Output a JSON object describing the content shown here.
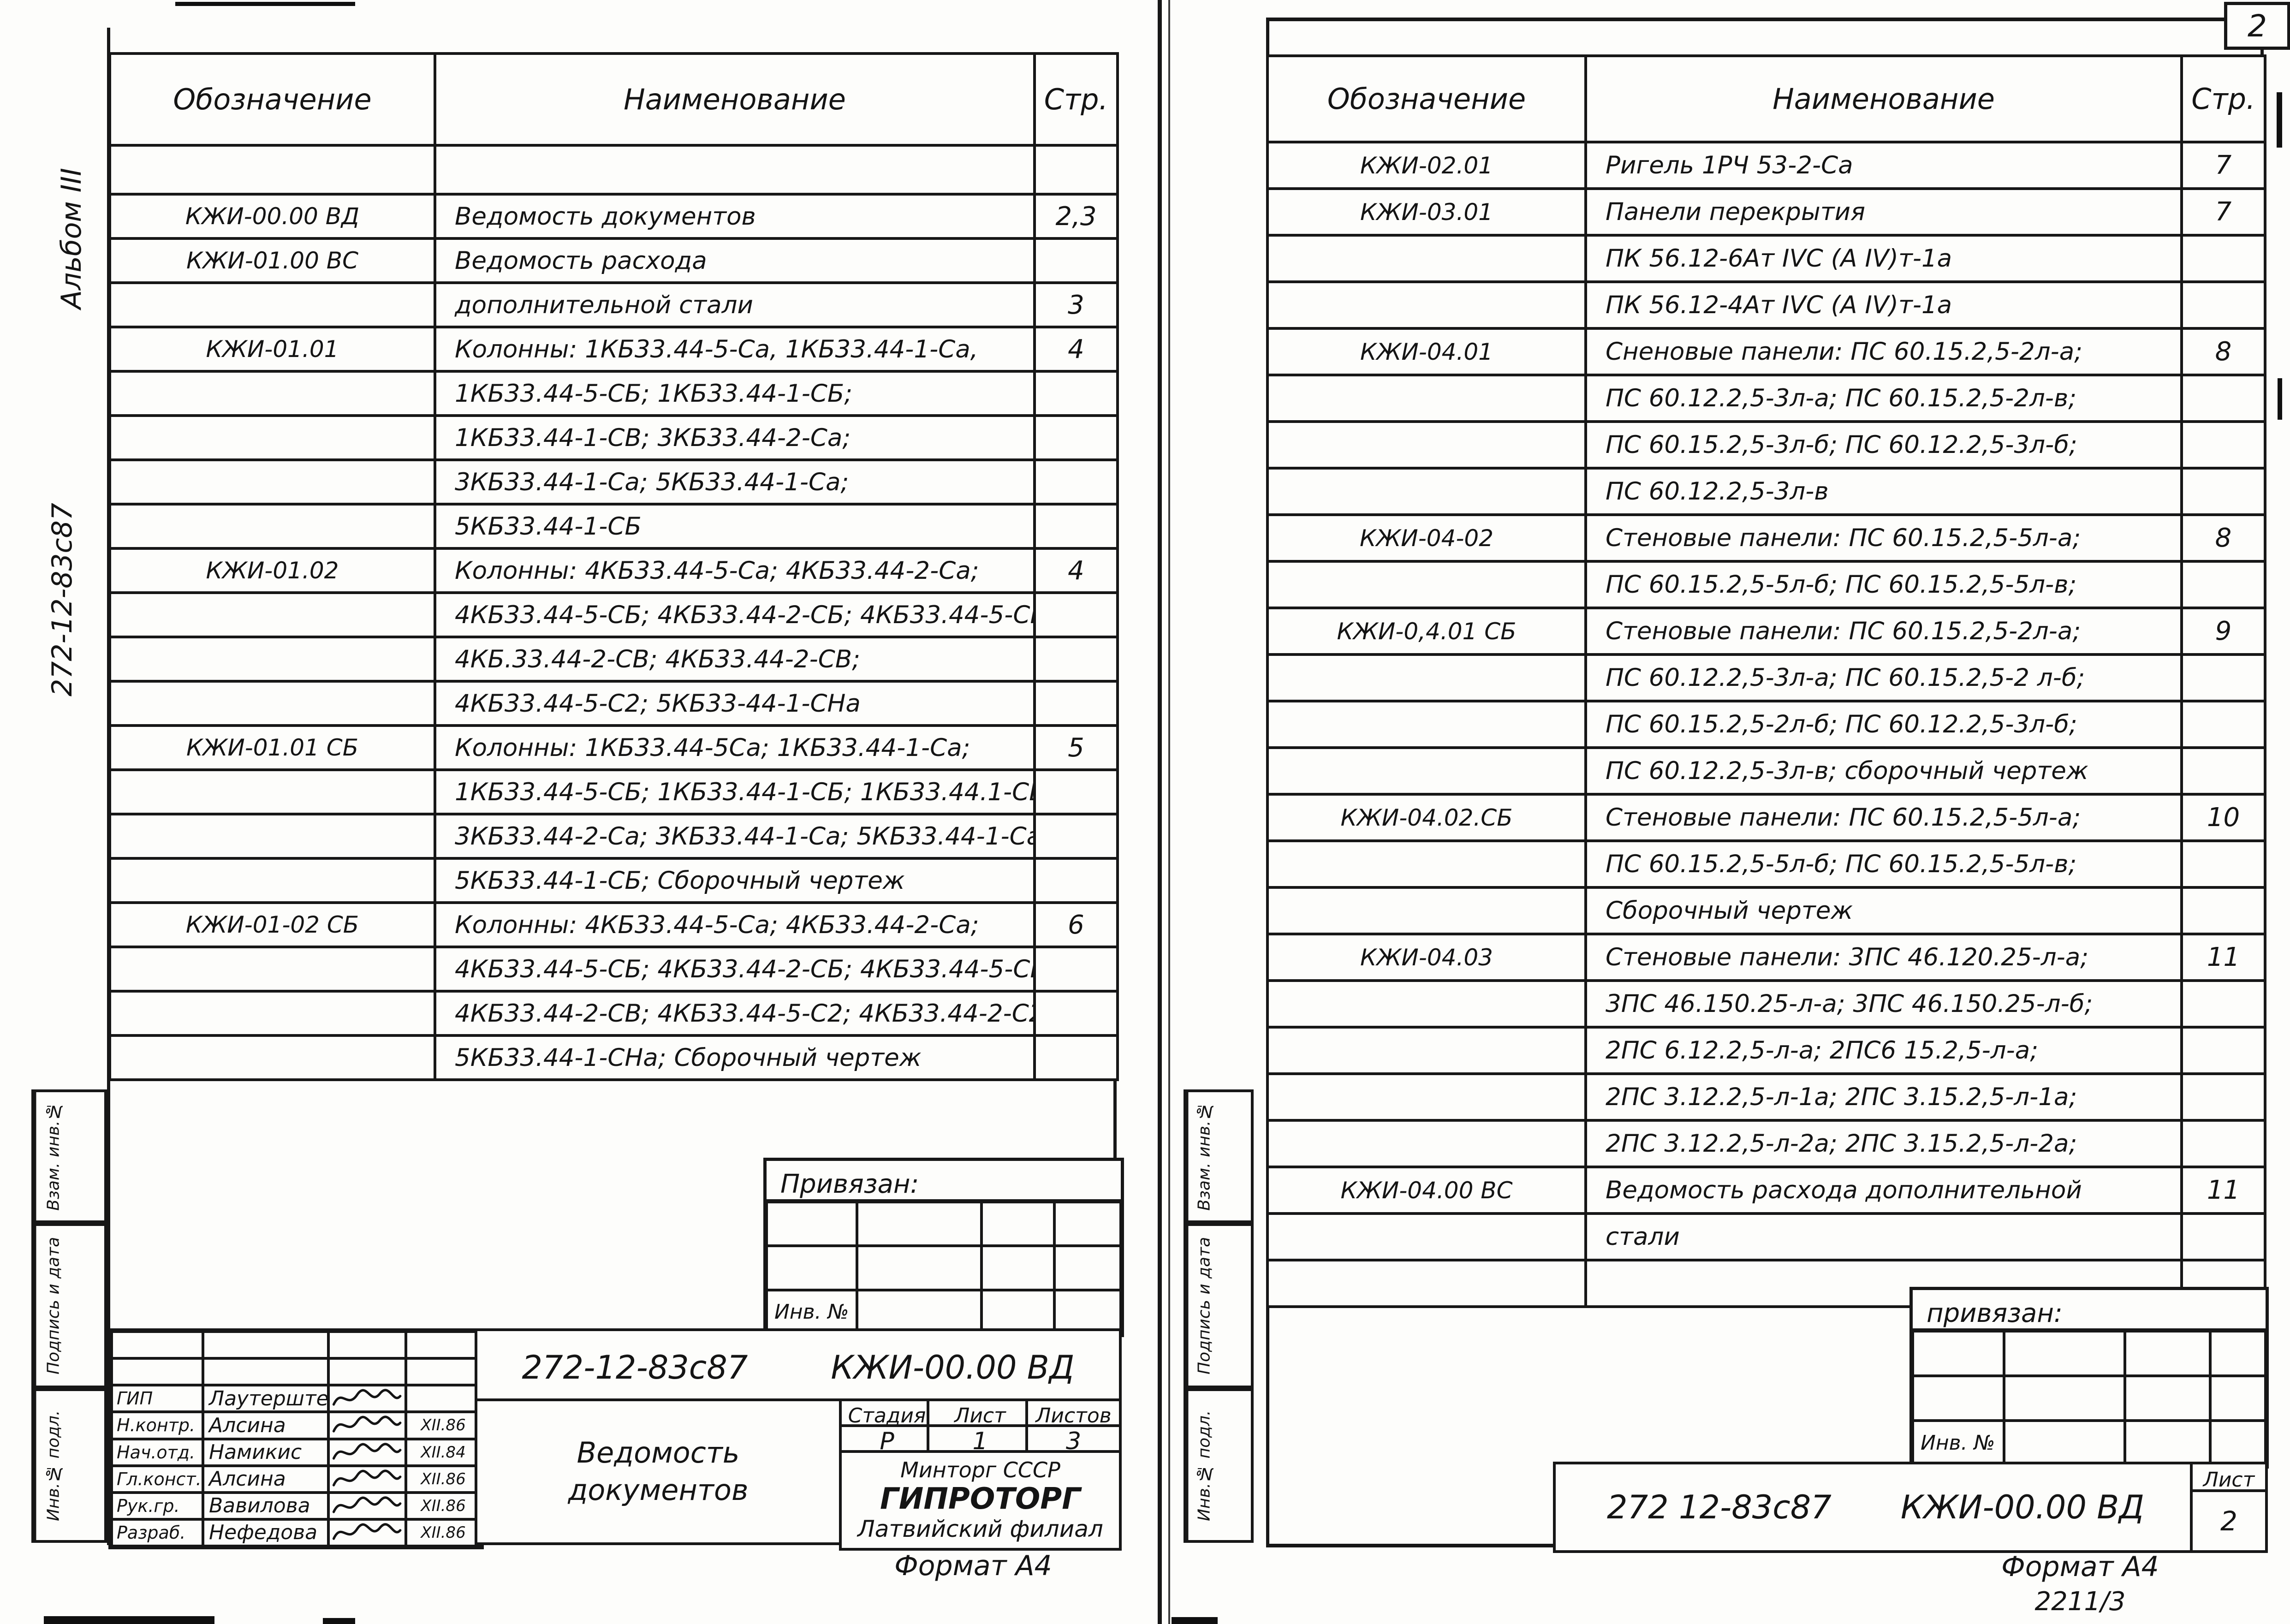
{
  "scan": {
    "corner_number": "2"
  },
  "left_page": {
    "margin": {
      "album_note": "Альбом III",
      "doc_code_note": "272-12-83с87",
      "stamps": [
        "Взам. инв.№",
        "Подпись и дата",
        "Инв.№ подл."
      ]
    },
    "table": {
      "headers": [
        "Обозначение",
        "Наименование",
        "Стр."
      ],
      "rows": [
        [
          "",
          "",
          ""
        ],
        [
          "КЖИ-00.00 ВД",
          "Ведомость документов",
          "2,3"
        ],
        [
          "КЖИ-01.00 ВС",
          "Ведомость расхода",
          ""
        ],
        [
          "",
          "дополнительной стали",
          "3"
        ],
        [
          "КЖИ-01.01",
          "Колонны: 1КБ33.44-5-Са, 1КБ33.44-1-Са,",
          "4"
        ],
        [
          "",
          "1КБ33.44-5-СБ; 1КБ33.44-1-СБ;",
          ""
        ],
        [
          "",
          "1КБ33.44-1-СВ; 3КБ33.44-2-Са;",
          ""
        ],
        [
          "",
          "3КБ33.44-1-Са; 5КБ33.44-1-Са;",
          ""
        ],
        [
          "",
          "5КБ33.44-1-СБ",
          ""
        ],
        [
          "КЖИ-01.02",
          "Колонны: 4КБ33.44-5-Са; 4КБ33.44-2-Са;",
          "4"
        ],
        [
          "",
          "4КБ33.44-5-СБ; 4КБ33.44-2-СБ; 4КБ33.44-5-СВ;",
          ""
        ],
        [
          "",
          "4КБ.33.44-2-СВ; 4КБ33.44-2-СВ;",
          ""
        ],
        [
          "",
          "4КБ33.44-5-С2; 5КБ33-44-1-СНа",
          ""
        ],
        [
          "КЖИ-01.01 СБ",
          "Колонны: 1КБ33.44-5Са; 1КБ33.44-1-Са;",
          "5"
        ],
        [
          "",
          "1КБ33.44-5-СБ; 1КБ33.44-1-СБ; 1КБ33.44.1-СВ;",
          ""
        ],
        [
          "",
          "3КБ33.44-2-Са; 3КБ33.44-1-Са; 5КБ33.44-1-Са",
          ""
        ],
        [
          "",
          "5КБ33.44-1-СБ; Сборочный чертеж",
          ""
        ],
        [
          "КЖИ-01-02 СБ",
          "Колонны: 4КБ33.44-5-Са; 4КБ33.44-2-Са;",
          "6"
        ],
        [
          "",
          "4КБ33.44-5-СБ; 4КБ33.44-2-СБ; 4КБ33.44-5-СВ;",
          ""
        ],
        [
          "",
          "4КБ33.44-2-СВ; 4КБ33.44-5-С2; 4КБ33.44-2-С2;",
          ""
        ],
        [
          "",
          "5КБ33.44-1-СНа; Сборочный чертеж",
          ""
        ]
      ]
    },
    "binding_box": {
      "title": "Привязан:",
      "inv_label": "Инв. №"
    },
    "title_block": {
      "doc_designation": "272-12-83с87",
      "doc_code": "КЖИ-00.00 ВД",
      "doc_title": "Ведомость документов",
      "stage_label": "Стадия",
      "sheet_label": "Лист",
      "sheets_label": "Листов",
      "stage": "Р",
      "sheet": "1",
      "sheets": "3",
      "org_line1": "Минторг СССР",
      "org_line2": "ГИПРОТОРГ",
      "org_line3": "Латвийский филиал",
      "signatures": [
        {
          "role": "ГИП",
          "name": "Лаутерштейн",
          "date": ""
        },
        {
          "role": "Н.контр.",
          "name": "Алсина",
          "date": "XII.86"
        },
        {
          "role": "Нач.отд.",
          "name": "Намикис",
          "date": "XII.84"
        },
        {
          "role": "Гл.конст.",
          "name": "Алсина",
          "date": "XII.86"
        },
        {
          "role": "Рук.гр.",
          "name": "Вавилова",
          "date": "XII.86"
        },
        {
          "role": "Разраб.",
          "name": "Нефедова",
          "date": "XII.86"
        }
      ]
    },
    "format_note": "Формат А4"
  },
  "right_page": {
    "margin": {
      "stamps": [
        "Взам. инв.№",
        "Подпись и дата",
        "Инв.№ подл."
      ]
    },
    "table": {
      "headers": [
        "Обозначение",
        "Наименование",
        "Стр."
      ],
      "rows": [
        [
          "КЖИ-02.01",
          "Ригель 1РЧ 53-2-Са",
          "7"
        ],
        [
          "КЖИ-03.01",
          "Панели перекрытия",
          "7"
        ],
        [
          "",
          "ПК 56.12-6Ат IVС (А IV)т-1а",
          ""
        ],
        [
          "",
          "ПК 56.12-4Ат IVС (А IV)т-1а",
          ""
        ],
        [
          "КЖИ-04.01",
          "Сненовые панели: ПС 60.15.2,5-2л-а;",
          "8"
        ],
        [
          "",
          "ПС 60.12.2,5-3л-а; ПС 60.15.2,5-2л-в;",
          ""
        ],
        [
          "",
          "ПС 60.15.2,5-3л-б; ПС 60.12.2,5-3л-б;",
          ""
        ],
        [
          "",
          "ПС 60.12.2,5-3л-в",
          ""
        ],
        [
          "КЖИ-04-02",
          "Стеновые панели: ПС 60.15.2,5-5л-а;",
          "8"
        ],
        [
          "",
          "ПС 60.15.2,5-5л-б; ПС 60.15.2,5-5л-в;",
          ""
        ],
        [
          "КЖИ-0,4.01 СБ",
          "Стеновые панели: ПС 60.15.2,5-2л-а;",
          "9"
        ],
        [
          "",
          "ПС 60.12.2,5-3л-а; ПС 60.15.2,5-2 л-б;",
          ""
        ],
        [
          "",
          "ПС 60.15.2,5-2л-б; ПС 60.12.2,5-3л-б;",
          ""
        ],
        [
          "",
          "ПС 60.12.2,5-3л-в; сборочный чертеж",
          ""
        ],
        [
          "КЖИ-04.02.СБ",
          "Стеновые панели: ПС 60.15.2,5-5л-а;",
          "10"
        ],
        [
          "",
          "ПС 60.15.2,5-5л-б; ПС 60.15.2,5-5л-в;",
          ""
        ],
        [
          "",
          "Сборочный чертеж",
          ""
        ],
        [
          "КЖИ-04.03",
          "Стеновые панели: 3ПС 46.120.25-л-а;",
          "11"
        ],
        [
          "",
          "3ПС 46.150.25-л-а; 3ПС 46.150.25-л-б;",
          ""
        ],
        [
          "",
          "2ПС 6.12.2,5-л-а; 2ПС6 15.2,5-л-а;",
          ""
        ],
        [
          "",
          "2ПС 3.12.2,5-л-1а; 2ПС 3.15.2,5-л-1а;",
          ""
        ],
        [
          "",
          "2ПС 3.12.2,5-л-2а; 2ПС 3.15.2,5-л-2а;",
          ""
        ],
        [
          "КЖИ-04.00 ВС",
          "Ведомость расхода дополнительной",
          "11"
        ],
        [
          "",
          "стали",
          ""
        ],
        [
          "",
          "",
          ""
        ]
      ]
    },
    "binding_box": {
      "title": "привязан:",
      "inv_label": "Инв. №"
    },
    "title_block": {
      "doc_designation": "272 12-83с87",
      "doc_code": "КЖИ-00.00 ВД",
      "sheet_label": "Лист",
      "sheet": "2"
    },
    "format_note": "Формат А4",
    "handwritten_ref": "2211/3"
  }
}
